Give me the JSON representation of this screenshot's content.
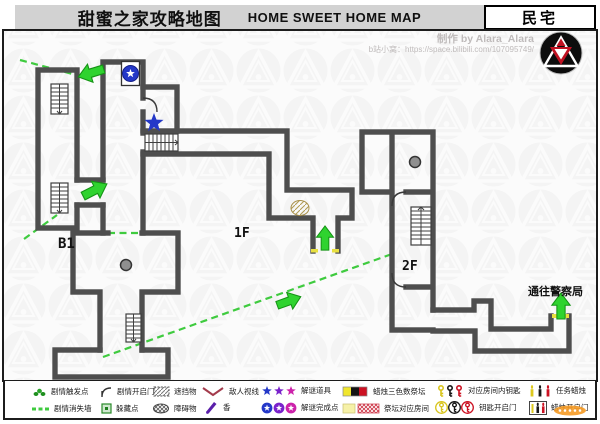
{
  "header": {
    "title_zh": "甜蜜之家攻略地图",
    "title_en": "HOME SWEET HOME MAP",
    "badge": "民宅"
  },
  "credits": {
    "author": "制作 by Alara_Alara",
    "link": "b站小窝：https://space.bilibili.com/107095749/"
  },
  "map": {
    "labels": {
      "b1": "B1",
      "f1": "1F",
      "f2": "2F",
      "exit": "通往警察局"
    },
    "accent_green": "#2fd32f",
    "star_blue": "#2438c8",
    "wall_gray": "#4e4e4e"
  },
  "legend": {
    "rows": [
      [
        "剧情触发点",
        "剧情开启门",
        "遮挡物",
        "敌人视线",
        "解谜道具",
        "蜡烛三色数祭坛",
        "对应房间内钥匙",
        "任务蜡烛"
      ],
      [
        "剧情消失墙",
        "躲藏点",
        "障碍物",
        "香",
        "解谜完成点",
        "祭坛对应房间",
        "钥匙开启门",
        "蜡烛开启门"
      ]
    ]
  }
}
